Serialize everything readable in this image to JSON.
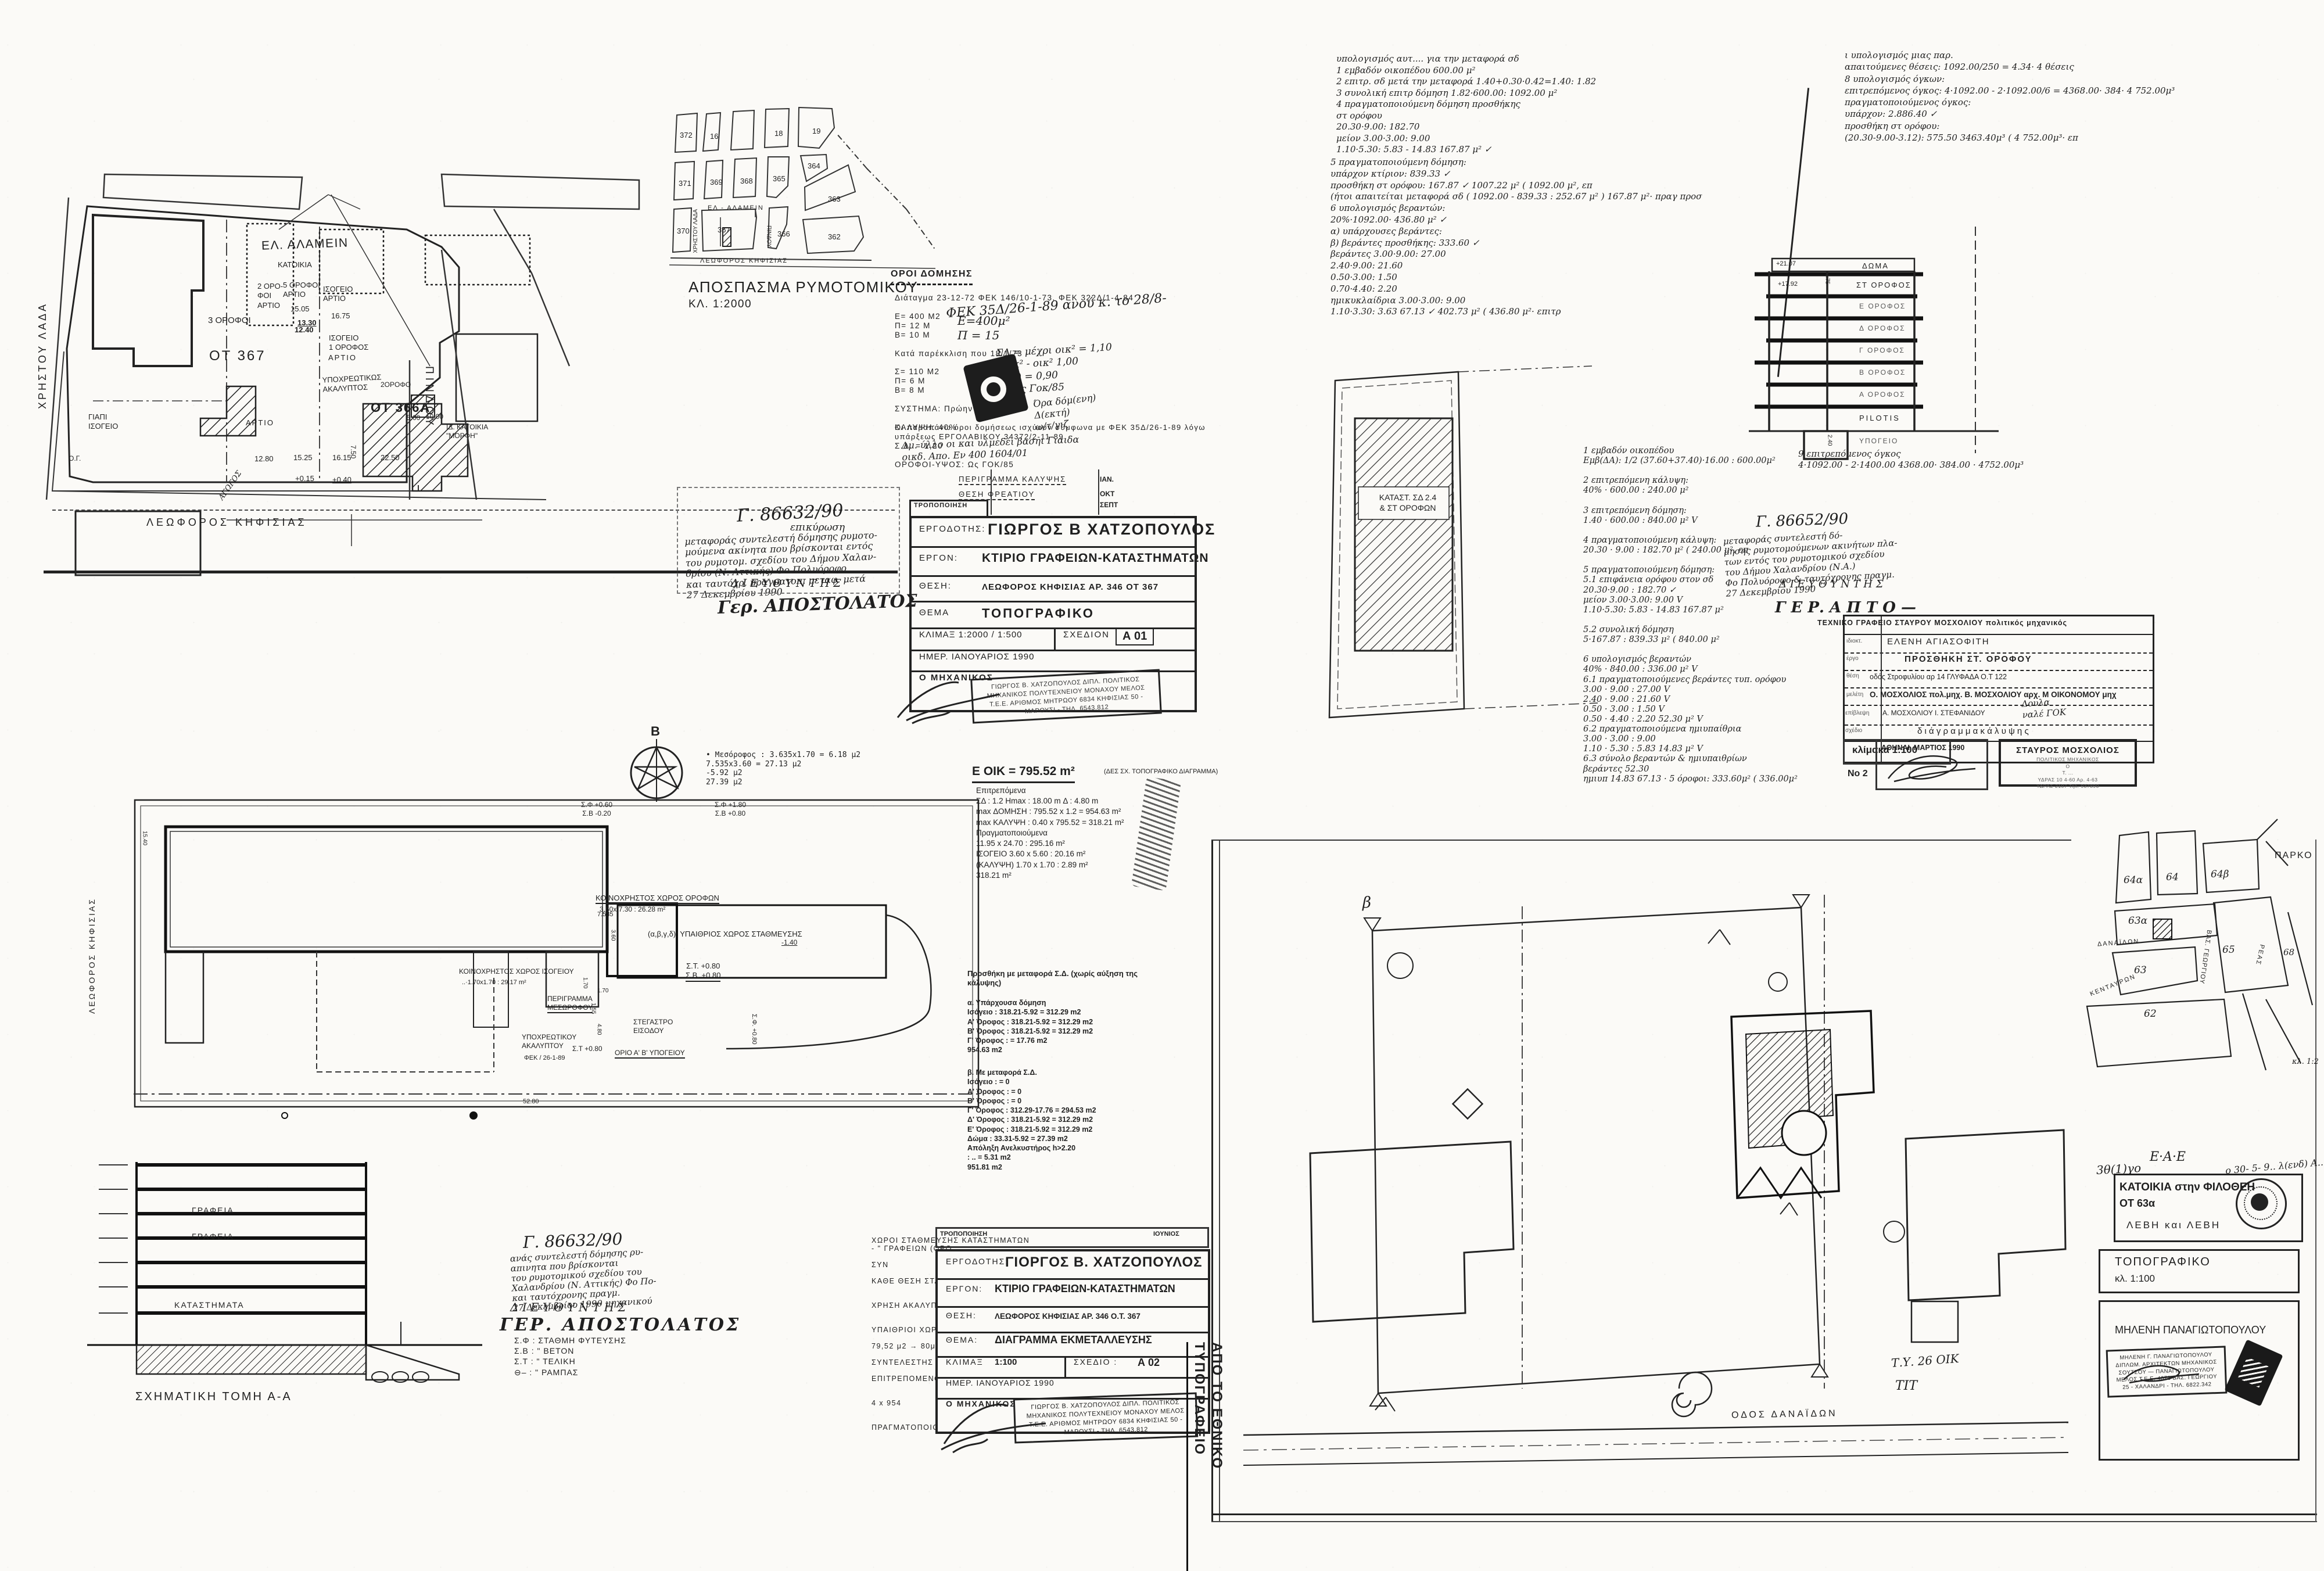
{
  "a01": {
    "site": {
      "street_top": "ΕΛ. ΑΛΑΜΕΙΝ",
      "street_right": "ΠΙΝΔΟΥ",
      "street_bottom": "ΛΕΩΦΟΡΟΣ   ΚΗΦΙΣΙΑΣ",
      "street_left": "ΧΡΗΣΤΟΥ ΛΑΔΑ",
      "block": "ΟΤ 367",
      "block2": "ΟΤ 366Α",
      "katoikia": "ΚΑΤΟΙΚΙΑ",
      "b1": "3 ΟΡΟΦΟΙ",
      "b2": "2 ΟΡΟ-\nΦΟΙ\nΑΡΤΙΟ",
      "b3": "5 ΟΡΟΦΟΙ\nΑΡΤΙΟ",
      "b4": "ΙΣΟΓΕΙΟ\nΑΡΤΙΟ",
      "b5": "ΙΣΟΓΕΙΟ\n1 ΟΡΟΦΟΣ",
      "b6": "ΑΡΤΙΟ",
      "b7": "ΑΡΤΙΟ",
      "b8": "ΓΙΑΠΙ\nΙΣΟΓΕΙΟ",
      "b9": "ΥΠΟΧΡΕΩΤΙΚΩΣ\nΑΚΑΛΥΠΤΟΣ",
      "b10": "2ΟΡΟΦΟ",
      "b12": "ΙΔ. ΚΑΤΟΙΚΙΑ\n\"ΜΟΡΦΗ\"",
      "og": "Ο.Γ.",
      "agogos": "ΑΓΩΓΟΣ",
      "d1": "15.05",
      "d2": "13.30",
      "d3": "12.40",
      "d4": "16.75",
      "d5": "12.80",
      "d6": "15.25",
      "d7": "16.15",
      "d8": "7.50",
      "d9": "22.50",
      "d10": "+0.15",
      "d11": "+0.40",
      "d12": "5.00",
      "d13": "10.00"
    },
    "rymo": {
      "caption": "ΑΠΟΣΠΑΣΜΑ  ΡΥΜΟΤΟΜΙΚΟΥ",
      "scale": "ΚΛ. 1:2000",
      "n372": "372",
      "n16": "16",
      "n18": "18",
      "n19": "19",
      "n371": "371",
      "n369": "369",
      "n368": "368",
      "n365": "365",
      "n364": "364",
      "n363": "363",
      "n370": "370",
      "n367": "367",
      "n366": "366",
      "n362": "362",
      "st1": "ΕΛ - ΑΛΑΜΕΙΝ",
      "st2": "ΛΕΩΦΟΡΟΣ  ΚΗΦΙΣΙΑΣ",
      "st3": "ΧΡΗΣΤΟΥ ΛΑΔΑ",
      "st4": "ΠΙΝΔΟΥ"
    },
    "oroi": {
      "title": "ΟΡΟΙ ΔΟΜΗΣΗΣ",
      "lines": [
        "Διάταγμα 23-12-72  ΦΕΚ 146/10-1-73, ΦΕΚ 322Δ/1-4-84",
        "",
        "Ε= 400 Μ2",
        "Π=  12 Μ",
        "Β=  10 Μ",
        "",
        "Κατά παρέκκλιση που 18/1/73",
        "",
        "Σ= 110 Μ2",
        "Π=   6 Μ",
        "Β=   8 Μ",
        "",
        "ΣΥΣΤΗΜΑ: Πρώην παντελ.",
        "",
        "ΚΑΛΥΨΗ: 40%",
        "",
        "Σ.Δ. = 1,20",
        "",
        "ΟΡΟΦΟΙ-ΥΨΟΣ: Ως ΓΟΚ/85"
      ],
      "lines2": [
        "Οι παραπάνω όροι δομήσεως ισχύουν σύμφωνα με ΦΕΚ 35Δ/26-1-89 λόγω",
        "υπάρξεως  ΕΡΓΟΛΑΒΙΚΟΥ  34372/2-11-89"
      ],
      "hw1": "ΦΕΚ 35Δ/26-1-89   ανού κ. το 28/8-",
      "hw2": "Ε=400μ²\nΠ = 15",
      "hw3": "ΣΔ = μέχρι οικ² = 1,10\nμοικ² - οικ²  1,00\nοικ²)  =  0,90\nΙσχύς Γοκ/85",
      "hw4": "Όρα δόμ(ενη)\nΔ(εκτή)\nω/τ/γιζ",
      "hw5": "Δμ. ύλλο  οι  και  υλμεδέι  βασηι Γιαιδα\nοικδ. Απο. Εν 400   1604/01"
    },
    "minitable": {
      "r1": "ΠΕΡΙΓΡΑΜΜΑ  ΚΑΛΥΨΗΣ",
      "d1": "ΙΑΝ.",
      "r2": "ΘΕΣΗ  ΦΡΕΑΤΙΟΥ",
      "d2": "ΟΚΤ",
      "r3": "ΤΡΟΠΟΠΟΙΗΣΗ",
      "d3": "ΣΕΠΤ"
    },
    "tb": {
      "l1": "ΕΡΓΟΔΟΤΗΣ:",
      "v1": "ΓΙΩΡΓΟΣ  Β  ΧΑΤΖΟΠΟΥΛΟΣ",
      "l2": "ΕΡΓΟΝ:",
      "v2": "ΚΤΙΡΙΟ   ΓΡΑΦΕΙΩΝ-ΚΑΤΑΣΤΗΜΑΤΩΝ",
      "l3": "ΘΕΣΗ:",
      "v3": "ΛΕΩΦΟΡΟΣ  ΚΗΦΙΣΙΑΣ   ΑΡ. 346      ΟΤ 367",
      "l4": "ΘΕΜΑ",
      "v4": "ΤΟΠΟΓΡΑΦΙΚΟ",
      "l5": "ΚΛΙΜΑΞ  1:2000  /  1:500",
      "l5b": "ΣΧΕΔΙΟΝ",
      "v5": "Α 01",
      "l6": "ΗΜΕΡ.     ΙΑΝΟΥΑΡΙΟΣ  1990",
      "l7": "Ο ΜΗΧΑΝΙΚΟΣ",
      "stamp": "ΓΙΩΡΓΟΣ Β. ΧΑΤΖΟΠΟΥΛΟΣ\nΔΙΠΛ. ΠΟΛΙΤΙΚΟΣ ΜΗΧΑΝΙΚΟΣ\nΠΟΛΥΤΕΧΝΕΙΟΥ ΜΟΝΑΧΟΥ\nΜΕΛΟΣ Τ.Ε.Ε. ΑΡΙΘΜΟΣ ΜΗΤΡΩΟΥ 6834\nΚΗΦΙΣΙΑΣ 50 - ΜΑΡΟΥΣΙ - ΤΗΛ. 6543.812"
    },
    "permit": {
      "ref": "Γ. 86632/90",
      "sub": "επικύρωση",
      "body": "μεταφοράς συντελεστή δόμησης ρυμοτο-\nμούμενα ακίνητα που βρίσκονται εντός\nτου ρυμοτομ. σχεδίου του Δήμου Χαλαν-\nδρίου (Ν. Αττικής) Φο Πολυόροφο\nκαι ταυτόχρ. πραγματοπ. μεταφ. μετά\n27 Δεκεμβρίου 1990",
      "role": "Δ Ι Ε Υ Θ Υ Ν Τ Η Σ",
      "sig": "Γερ. ΑΠΟΣΤΟΛΑΤΟΣ"
    }
  },
  "mos": {
    "calc_top": [
      "υπολογισμός  αυτ....  για  την  μεταφορά  σδ",
      "1  εμβαδόν  οικοπέδου  600.00 μ²",
      "2  επιτρ. σδ  μετά  την  μεταφορά   1.40+0.30·0.42=1.40:  1.82",
      "3  συνολική  επιτρ  δόμηση    1.82·600.00:  1092.00 μ²",
      "4  πραγματοποιούμενη  δόμηση  προσθήκης",
      "        στ  ορόφου",
      "             20.30·9.00:       182.70",
      "        μείον  3.00·3.00: 9.00",
      "             1.10·5.30: 5.83  - 14.83     167.87 μ²  ✓"
    ],
    "calc_top2": [
      "5  πραγματοποιούμενη  δόμηση:",
      "        υπάρχον  κτίριον:        839.33 ✓",
      "        προσθήκη  στ  ορόφου:  167.87 ✓   1007.22 μ² ( 1092.00 μ², επ",
      "  (ήτοι  απαιτείται  μεταφορά  σδ ( 1092.00 - 839.33 :  252.67 μ² )  167.87 μ²· πραγ  προσ",
      "6  υπολογισμός  βεραντών:",
      "             20%·1092.00·  436.80 μ²   ✓",
      "        α) υπάρχουσες  βεράντες:",
      "        β) βεράντες  προσθήκης:        333.60 ✓",
      "             βεράντες  3.00·9.00: 27.00",
      "                       2.40·9.00: 21.60",
      "                       0.50·3.00:  1.50",
      "                       0.70·4.40:  2.20",
      "             ημικυκλαίδρια  3.00·3.00: 9.00",
      "                  1.10·3.30: 3.63    67.13 ✓   402.73 μ² ( 436.80 μ²·  επιτρ"
    ],
    "calc_right": [
      "ι  υπολογισμός  μιας  παρ.",
      "      απαιτούμενες  θέσεις:  1092.00/250 = 4.34·  4 θέσεις",
      "8  υπολογισμός  όγκων:",
      "      επιτρεπόμενος  όγκος:   4·1092.00 - 2·1092.00/6  = 4368.00· 384·  4 752.00μ³",
      "      πραγματοποιούμενος  όγκος:",
      "            υπάρχον:          2.886.40  ✓",
      "            προσθήκη  στ  ορόφου:",
      "            (20.30-9.00-3.12):    575.50   3463.40μ³ ( 4 752.00μ³· επ"
    ],
    "calc_mid": [
      "1 εμβαδόν  οικοπέδου",
      "      Εμβ(ΔΑ):  1/2 (37.60+37.40)·16.00 : 600.00μ²",
      "",
      "2 επιτρεπόμενη  κάλυψη:",
      "      40% · 600.00 : 240.00 μ²",
      "",
      "3 επιτρεπόμενη  δόμηση:",
      "      1.40 · 600.00 : 840.00 μ²  V",
      "",
      "4 πραγματοποιούμενη  κάλυψη:",
      "      20.30 · 9.00 : 182.70 μ² ( 240.00 μ², επ",
      "",
      "5 πραγματοποιούμενη  δόμηση:",
      "    5.1  επιφάνεια  ορόφου  στον  σδ",
      "         20.30·9.00  :  182.70 ✓",
      "       μείον 3.00·3.00: 9.00 V",
      "         1.10·5.30: 5.83  - 14.83    167.87 μ²",
      "",
      "    5.2  συνολική  δόμηση",
      "         5·167.87 :  839.33 μ² ( 840.00 μ²",
      "",
      "6  υπολογισμός  βεραντών",
      "      40% · 840.00 : 336.00 μ² V",
      "    6.1  πραγματοποιούμενες  βεράντες  τυπ. ορόφου",
      "         3.00 · 9.00 :  27.00 V",
      "         2.40 · 9.00 :  21.60 V",
      "         0.50 · 3.00 :   1.50 V",
      "         0.50 · 4.40 :   2.20      52.30 μ² V",
      "    6.2  πραγματοποιούμενα  ημιυπαίθρια",
      "         3.00 · 3.00 :  9.00",
      "         1.10 · 5.30 :  5.83     14.83 μ² V",
      "    6.3  σύνολο  βεραντών  &  ημιυπαιθρίων",
      "         βεράντες   52.30",
      "         ημιυπ      14.83    67.13 · 5 όροφοι:  333.60μ² ( 336.00μ²"
    ],
    "volnote": "9  επιτρεπόμενος  όγκος\n        4·1092.00 - 2·1400.00   4368.00· 384.00 · 4752.00μ³",
    "elev": {
      "doma": "ΔΩΜΑ",
      "f6": "ΣΤ ΟΡΟΦΟΣ",
      "f5": "Ε ΟΡΟΦΟΣ",
      "f4": "Δ ΟΡΟΦΟΣ",
      "f3": "Γ ΟΡΟΦΟΣ",
      "f2": "Β ΟΡΟΦΟΣ",
      "f1": "Α ΟΡΟΦΟΣ",
      "pil": "PILOTIS",
      "bas": "ΥΠΟΓΕΙΟ",
      "m1": "+21.07",
      "m2": "+17.92",
      "h1": "2.75",
      "h2": "2.40"
    },
    "plan_label": "ΚΑΤΑΣΤ. ΣΔ 2.4\n& ΣΤ ΟΡΟΦΩΝ",
    "permit2": {
      "ref": "Γ.  86652/90",
      "body": "μεταφοράς συντελεστή δό-\nμησης ρυμοτομούμενων ακινήτων πλα-\nτων εντός του ρυμοτομικού σχεδίου\nτου Δήμου Χαλανδρίου (Ν.Α.)\nΦο Πολυόροφο & ταυτόχρονης πραγμ.\n27 Δεκεμβρίου 1990",
      "role": "Δ Ι Ε Υ Θ Υ Ν Τ Η Σ",
      "sig": "Γ Ε Ρ.  Α Π Τ Ο —"
    },
    "table": {
      "r1": "ΤΕΧΝΙΚΟ   ΓΡΑΦΕΙΟ      ΣΤΑΥΡΟΥ    ΜΟΣΧΟΛΙΟΥ     πολιτικός   μηχανικός",
      "k2": "ιδιοκτ.",
      "r2": "ΕΛΕΝΗ       ΑΓΙΑΣΟΦΙΤΗ",
      "k3": "έργο",
      "r3": "ΠΡΟΣΘΗΚΗ   ΣΤ. ΟΡΟΦΟΥ",
      "k4": "θέση",
      "r4": "οδός  Στροφυλίου  αρ  14          ΓΛΥΦΑΔΑ           Ο.Τ  122",
      "k5": "μελέτη",
      "r5": "Ο. ΜΟΣΧΟΛΙΟΣ πολ.μηχ.   Β. ΜΟΣΧΟΛΙΟΥ αρχ.   Μ ΟΙΚΟΝΟΜΟΥ μηχ",
      "k6": "επίβλεψη",
      "r6": "Α. ΜΟΣΧΟΛΙΟΥ            Ι. ΣΤΕΦΑΝΙΔΟΥ",
      "hw6": "Δουλα\nναλέ ΓΟΚ",
      "k7": "σχέδιο",
      "r7": "δ ι ά γ ρ α μ μ α    κ ά λ υ ψ η ς",
      "scale": "κλίμακα 1:100",
      "no": "Νο 2",
      "date": "ΑΘΗΝΑΙ, ΜΑΡΤΙΟΣ 1990",
      "stamp1": "ΣΤΑΥΡΟΣ ΜΟΣΧΟΛΙΟΣ",
      "stamp2": "ΠΟΛΙΤΙΚΟΣ ΜΗΧΑΝΙΚΟΣ\nΟ\nΤ. ...\nΥΔΡΑΣ 10 4-60   Αρ.   4-63\nΥΔΡΑΣ 2107       Τηλ. 937890"
    }
  },
  "a02": {
    "compass": "B",
    "mesorofos": "•  Μεσόροφος :  3.635x1.70  =   6.18  μ2\n                7.535x3.60  =  27.13  μ2\n                               -5.92  μ2\n                               27.39  μ2",
    "eoik_head": "Ε ΟΙΚ = 795.52 m²",
    "eoik_note": "(ΔΕΣ ΣΧ. ΤΟΠΟΓΡΑΦΙΚΟ ΔΙΑΓΡΑΜΜΑ)",
    "eoik1": "Επιτρεπόμενα\nΣΔ : 1.2   Hmax : 18.00 m        Δ :      4.80 m\nmax ΔΟΜΗΣΗ : 795.52 x 1.2    = 954.63 m²\nmax ΚΑΛΥΨΗ :  0.40 x 795.52 = 318.21 m²\nΠραγματοποιούμενα\n                 11.95 x 24.70 :  295.16 m²\nΙΣΟΓΕΙΟ       3.60 x  5.60 :    20.16 m²\n(ΚΑΛΥΨΗ)      1.70 x  1.70 :      2.89 m²\n                                          318.21 m²",
    "eoik2": "Προσθήκη με μεταφορά Σ.Δ. (χωρίς αύξηση της\nκάλυψης)",
    "eoik3": "α.  Υπάρχουσα δόμηση\n     Ισόγειο    : 318.21-5.92    =  312.29  m2\n     Α' Όροφος : 318.21-5.92    =  312.29  m2\n     Β' Όροφος : 318.21-5.92    =  312.29  m2\n     Γ' Όροφος :                        =   17.76  m2\n                                                954.63 m2",
    "eoik4": "β.  Με μεταφορά Σ.Δ.\n     Ισόγειο    :                =  0\n     Α' Όροφος :                =  0\n     Β' Όροφος :                =  0\n     Γ' Όροφος : 312.29-17.76  =  294.53  m2\n     Δ' Όροφος : 318.21-5.92   =  312.29  m2\n     Ε' Όροφος : 318.21-5.92   =  312.29  m2\n     Δώμα       :  33.31-5.92   =   27.39  m2\n     Απόληξη Ανελκυστήρος h>2.20\n                  : ..               =    5.31  m2\n                                              951.81 m2",
    "plan": {
      "koino_orof": "ΚΟΙΝΟΧΡΗΣΤΟΣ   ΧΩΡΟΣ   ΟΡΟΦΩΝ",
      "koino_orof2": "3.60x 7.30 : 26.28  m²",
      "ypaithrios": "(α,β,γ,δ):  ΥΠΑΙΘΡΙΟΣ   ΧΩΡΟΣ   ΣΤΑΘΜΕΥΣΗΣ",
      "st_sb": "Σ.Τ. +0.80\nΣ.Β. +0.80",
      "sf1": "Σ.Φ +0.60\nΣ.Β -0.20",
      "sf2": "Σ.Φ +1.80\nΣ.Β +0.80",
      "sf3": "Σ.Φ. +0.80",
      "koino_isog": "ΚΟΙΝΟΧΡΗΣΤΟΣ  ΧΩΡΟΣ  ΙΣΟΓΕΙΟΥ",
      "koino_isog2": "..·1.70x1.70 : 29.17 m²",
      "perigramma": "ΠΕΡΙΓΡΑΜΜΑ\nΜΕΣΩΡΟΦΟΥ",
      "stegastro": "ΣΤΕΓΑΣΤΡΟ\nΕΙΣΟΔΟΥ",
      "orio": "ΟΡΙΟ   Α'  Β'  ΥΠΟΓΕΙΟΥ",
      "ypoxr": "ΥΠΟΧΡΕΩΤΙΚΟΥ\nΑΚΑΛΥΠΤΟΥ",
      "fek": "ΦΕΚ / 26-1-89",
      "st080": "Σ.Τ +0.80",
      "dim_7535": "7.535",
      "dim_360": "3.60",
      "dim_170a": "1.70",
      "dim_170b": "1.70",
      "dim_155": "1.55",
      "dim_480": "4.80",
      "dim_140": "-1.40",
      "dim_5280": "52.80",
      "dim_1540": "15.40"
    },
    "street_left": "ΛΕΩΦΟΡΟΣ  ΚΗΦΙΣΙΑΣ",
    "section_label": "ΣΧΗΜΑΤΙΚΗ   ΤΟΜΗ   Α-Α",
    "sec_f1": "ΓΡΑΦΕΙΑ",
    "sec_f2": "ΓΡΑΦΕΙΑ",
    "sec_f3": "ΚΑΤΑΣΤΗΜΑΤΑ",
    "legend": "Σ.Φ  :  ΣΤΑΘΜΗ  ΦΥΤΕΥΣΗΣ\nΣ.Β  :      \"        ΒΕΤΟΝ\nΣ.Τ  :      \"        ΤΕΛΙΚΗ\n⊖–  :      \"        ΡΑΜΠΑΣ",
    "permit": {
      "ref": "Γ. 86632/90",
      "body": "ανάς συντελεστή δόμησης ρυ-\nαπινητα που βρίσκονται\nτου ρυμοτομικού σχεδίου του\nΧαλανδρίου (Ν. Αττικής) Φο Πο-\nκαι ταυτόχρονης πραγμ.\n27 Δεκεμβρίου 1990  μηχανικού",
      "role": "Δ Ι Ε Υ Θ Υ Ν Τ Η Σ",
      "sig": "ΓΕΡ.  ΑΠΟΣΤΟΛΑΤΟΣ"
    },
    "parking": "ΧΩΡΟΙ  ΣΤΑΘΜΕΥΣΗΣ  ΚΑΤΑΣΤΗΜΑΤΩΝ\n-              \"              ΓΡΑΦΕΙΩΝ  (ΟΡΟ\n\n                                        ΣΥΝ\n\nΚΑΘΕ  ΘΕΣΗ  ΣΤΑΘΜΕΥΣΗΣ:  20 Μ2  επ\n\n\nΧΡΗΣΗ  ΑΚΑΛΥΠΤΟΥ  (Π.Δ.  3-8-87  &\n\n\nΥΠΑΙΘΡΙΟΙ  ΧΩΡΟΙ  ΣΤΑΘΜΕΥΣΗΣ:  10\n\n    79,52 μ2  →  80μ2  =  4  θέσεις\n\nΣΥΝΤΕΛΕΣΤΗΣ  ΟΓΚΟΥ:\n\nΕΠΙΤΡΕΠΟΜΕΝΟΣ  ΣΥΝΤΕΛ.     4  x  (α.\n\n\n                                   4  x  954\n\n\nΠΡΑΓΜΑΤΟΠΟΙΟΥΜΕΝΟΣ  ΣΥΝΤΕΛ.  =  2",
    "minitable": {
      "r1": "ΤΡΟΠΟΠΟΙΗΣΗ",
      "d1": "ΙΟΥΝΙΟΣ"
    },
    "tb": {
      "l1": "ΕΡΓΟΔΟΤΗΣ:",
      "v1": "ΓΙΟΡΓΟΣ  Β. ΧΑΤΖΟΠΟΥΛΟΣ",
      "l2": "ΕΡΓΟΝ:",
      "v2": "ΚΤΙΡΙΟ   ΓΡΑΦΕΙΩΝ-ΚΑΤΑΣΤΗΜΑΤΩΝ",
      "l3": "ΘΕΣΗ:",
      "v3": "ΛΕΩΦΟΡΟΣ  ΚΗΦΙΣΙΑΣ  ΑΡ. 346       Ο.Τ. 367",
      "l4": "ΘΕΜΑ:",
      "v4": "ΔΙΑΓΡΑΜΜΑ  ΕΚΜΕΤΑΛΛΕΥΣΗΣ",
      "l5": "ΚΛΙΜΑΞ",
      "v5a": "1:100",
      "l5b": "ΣΧΕΔΙΟ :",
      "v5": "Α 02",
      "l6": "ΗΜΕΡ.      ΙΑΝΟΥΑΡΙΟΣ  1990",
      "l7": "Ο ΜΗΧΑΝΙΚΟΣ",
      "stamp": "ΓΙΩΡΓΟΣ Β. ΧΑΤΖΟΠΟΥΛΟΣ\nΔΙΠΛ. ΠΟΛΙΤΙΚΟΣ ΜΗΧΑΝΙΚΟΣ\nΠΟΛΥΤΕΧΝΕΙΟΥ ΜΟΝΑΧΟΥ\nΜΕΛΟΣ Τ.Ε.Ε. ΑΡΙΘΜΟΣ ΜΗΤΡΩΟΥ 6834\nΚΗΦΙΣΙΑΣ 50 - ΜΑΡΟΥΣΙ - ΤΗΛ. 6543.812"
    }
  },
  "fil": {
    "vertical_print": "ΑΠΟ  ΤΟ  ΕΘΝΙΚΟ  ΤΥΠΟΓΡΑΦΕΙΟ",
    "keymap": {
      "parko": "ΠΑΡΚΟ",
      "n64a": "64α",
      "n64": "64",
      "n64b": "64β",
      "n63a": "63α",
      "n63": "63",
      "n65": "65",
      "n62": "62",
      "n68": "68",
      "st1": "ΔΑΝΑΪΔΩΝ",
      "st2": "ΚΕΝΤΑΥΡΩΝ",
      "st3": "ΒΑΣ. ΓΕΩΡΓΙΟΥ",
      "st4": "ΡΕΑΣ",
      "scale": "κλ. 1:2"
    },
    "plan": {
      "street": "ΟΔΟΣ   ΔΑΝΑΪΔΩΝ",
      "note": "Τ.Υ. 26 ΟΙΚ",
      "note2": "ΤΙΤ",
      "marker": "β"
    },
    "tb": {
      "hw_no": "3θ(1)γο",
      "hw_eae": "Ε·Α·Ε",
      "hw_date": "ο 30- 5- 9..   λ(ενδ) Α..",
      "title": "ΚΑΤΟΙΚΙΑ  στην  ΦΙΛΟΘΕΗ",
      "block": "ΟΤ   63α",
      "owners": "ΛΕΒΗ  και  ΛΕΒΗ",
      "drawing": "ΤΟΠΟΓΡΑΦΙΚΟ",
      "scale": "κλ.    1:100",
      "architect": "ΜΗΛΕΝΗ    ΠΑΝΑΓΙΩΤΟΠΟΥΛΟΥ",
      "stamp": "ΜΗΛΕΝΗ  Γ.  ΠΑΝΑΓΙΩΤΟΠΟΥΛΟΥ\nΔΙΠΛΩΜ. ΑΡΧΙΤΕΚΤΩΝ ΜΗΧΑΝΙΚΟΣ\nΣΟΥΤΣΟΥ — ΠΑΝΑΓΙΩΤΟΠΟΥΛΟΥ\nΜΕΛΟΣ Τ.Ε.Ε. 4673\nΒΑΣ. ΓΕΩΡΓΙΟΥ 25 - ΧΑΛΑΝΔΡΙ - ΤΗΛ. 6822.342"
    }
  }
}
